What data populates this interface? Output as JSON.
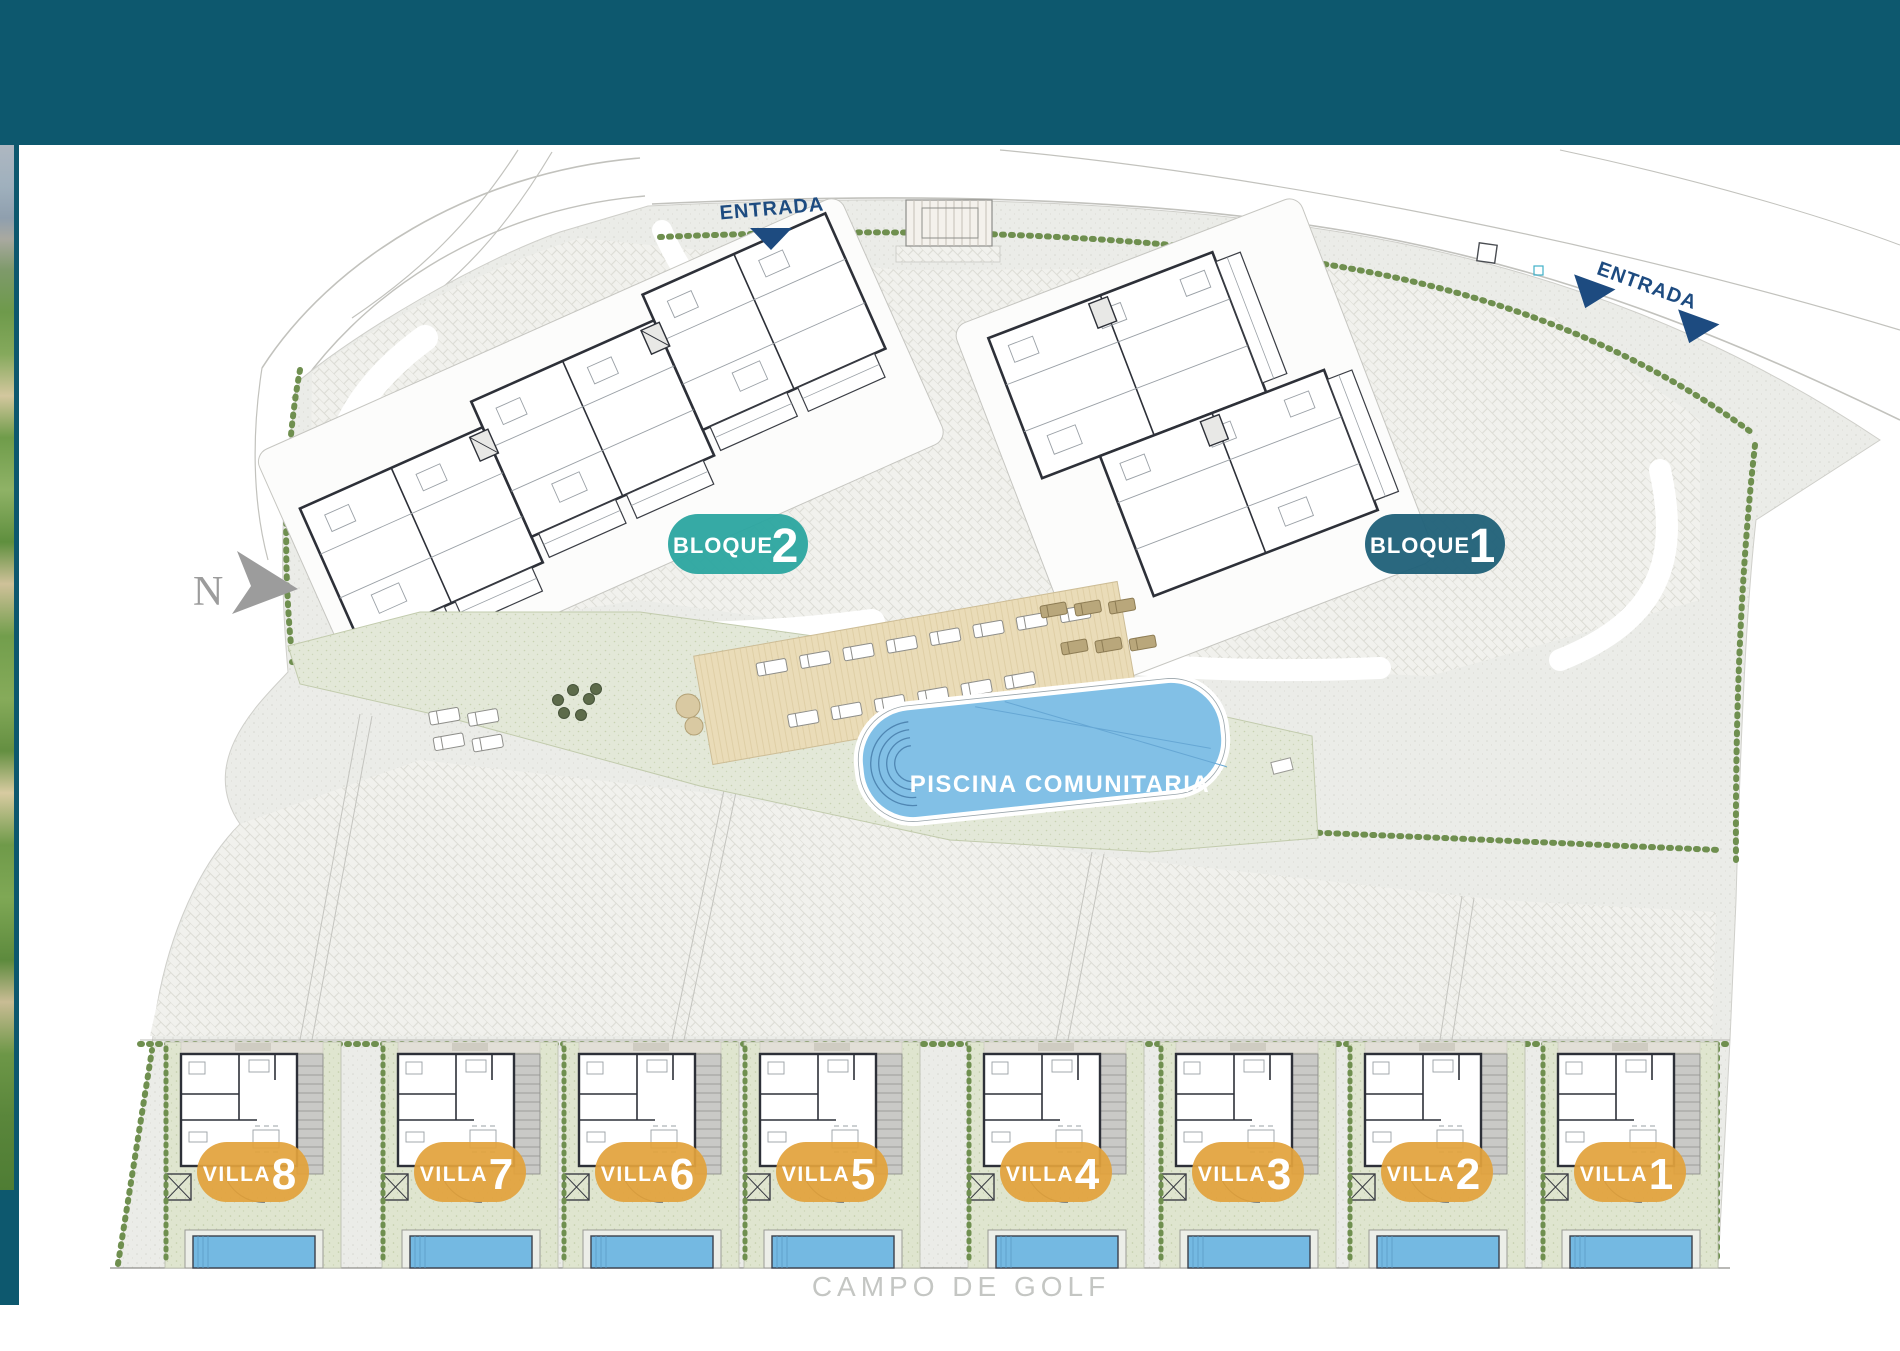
{
  "plan": {
    "entrada_top": "ENTRADA",
    "entrada_right": "ENTRADA",
    "north": "N",
    "pool_label": "PISCINA COMUNITARIA",
    "golf_label": "CAMPO DE GOLF",
    "blocks": [
      {
        "name": "BLOQUE",
        "number": "2"
      },
      {
        "name": "BLOQUE",
        "number": "1"
      }
    ],
    "villas": [
      {
        "name": "VILLA",
        "number": "8"
      },
      {
        "name": "VILLA",
        "number": "7"
      },
      {
        "name": "VILLA",
        "number": "6"
      },
      {
        "name": "VILLA",
        "number": "5"
      },
      {
        "name": "VILLA",
        "number": "4"
      },
      {
        "name": "VILLA",
        "number": "3"
      },
      {
        "name": "VILLA",
        "number": "2"
      },
      {
        "name": "VILLA",
        "number": "1"
      }
    ],
    "colors": {
      "header_teal": "#0d586e",
      "block2_badge": "#2ba5a0",
      "block1_badge": "#1f6078",
      "villa_badge": "#e2a33c",
      "entrada_navy": "#1d4b80",
      "pool_blue": "#82c0e6",
      "villa_pool_blue": "#74b9e2",
      "north_gray": "#9c9c9c",
      "golf_gray": "#c4c6c3",
      "hedge_green": "#6f8f4f"
    }
  }
}
